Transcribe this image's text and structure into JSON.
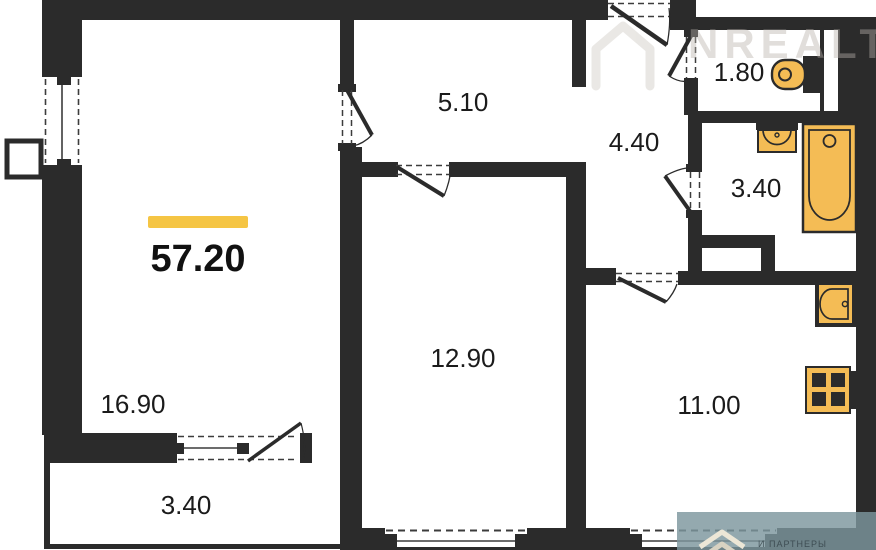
{
  "plan": {
    "type": "apartment-floorplan",
    "total_area": "57.20",
    "wall_color": "#2b2b2b",
    "fixture_color": "#f4bc55",
    "accent_bar_color": "#f5c544",
    "rooms": [
      {
        "name": "hallway",
        "area": "5.10"
      },
      {
        "name": "entry-hall",
        "area": "4.40"
      },
      {
        "name": "wc",
        "area": "1.80"
      },
      {
        "name": "bathroom",
        "area": "3.40"
      },
      {
        "name": "living-room",
        "area": "16.90"
      },
      {
        "name": "bedroom",
        "area": "12.90"
      },
      {
        "name": "kitchen",
        "area": "11.00"
      },
      {
        "name": "balcony",
        "area": "3.40"
      }
    ],
    "fixtures": [
      "toilet-icon",
      "sink-icon",
      "bathtub-icon",
      "kitchen-sink-icon",
      "stove-icon"
    ],
    "watermark": {
      "brand": "NREALT",
      "footer_fragment": "И ПАРТНЕРЫ"
    }
  }
}
